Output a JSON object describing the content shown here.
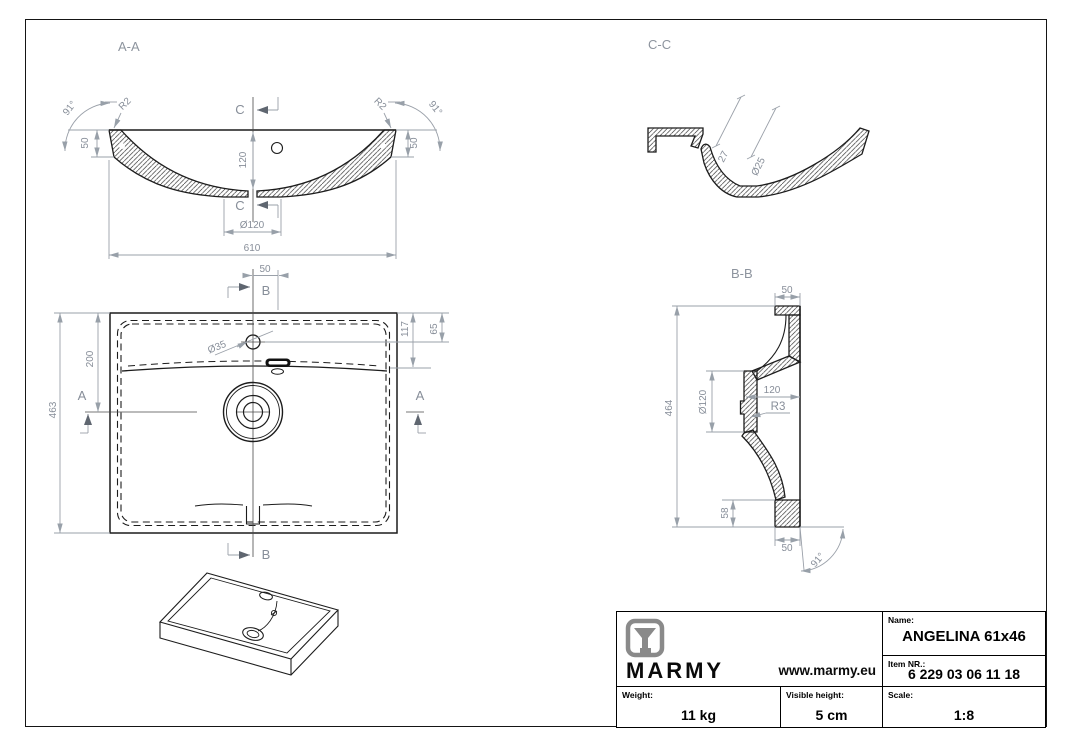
{
  "drawing": {
    "section_aa": {
      "label": "A-A",
      "cut_letter_top": "C",
      "cut_letter_bottom": "C",
      "angle_left": "91°",
      "angle_right": "91°",
      "radius_left": "R2",
      "radius_right": "R2",
      "rim_height_left": "50",
      "rim_height_right": "50",
      "basin_depth": "120",
      "drain_recess_dia": "Ø120",
      "overall_width": "610"
    },
    "section_cc": {
      "label": "C-C",
      "wall_offset": "27",
      "overflow_dia": "Ø25"
    },
    "plan": {
      "section_a_left": "A",
      "section_a_right": "A",
      "section_b_top": "B",
      "section_b_bottom": "B",
      "tap_to_overflow": "50",
      "overall_depth": "463",
      "front_to_center": "200",
      "edge_to_rim": "117",
      "edge_to_tap": "65",
      "tap_hole_dia": "Ø35"
    },
    "section_bb": {
      "label": "B-B",
      "deck_width_top": "50",
      "overall_height": "464",
      "drain_dia": "Ø120",
      "drain_offset": "120",
      "fillet_radius": "R3",
      "foot_height": "58",
      "foot_width": "50",
      "wall_angle": "91°"
    }
  },
  "title_block": {
    "brand": "MARMY",
    "website": "www.marmy.eu",
    "name_label": "Name:",
    "name_value": "ANGELINA 61x46",
    "item_label": "Item NR.:",
    "item_value": "6 229 03 06 11 18",
    "weight_label": "Weight:",
    "weight_value": "11 kg",
    "visible_height_label": "Visible height:",
    "visible_height_value": "5 cm",
    "scale_label": "Scale:",
    "scale_value": "1:8"
  }
}
